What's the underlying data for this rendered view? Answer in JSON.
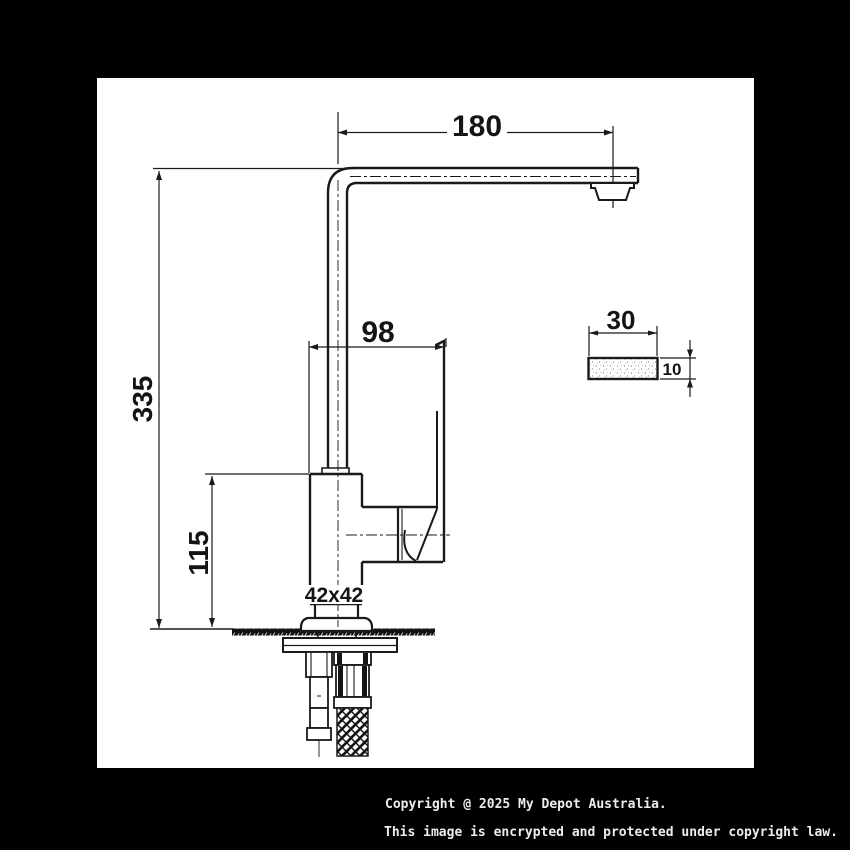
{
  "page": {
    "background": "#000000",
    "paper": "#ffffff",
    "ink": "#1a1a1a"
  },
  "drawing": {
    "title": "kitchen-mixer-tap-technical-drawing",
    "dimensions": {
      "spout_reach": "180",
      "overall_height": "335",
      "body_to_handle_tip": "98",
      "deck_to_spout_height": "115",
      "body_section": "42x42",
      "section_width": "30",
      "section_thickness": "10"
    }
  },
  "footer": {
    "line1": "Copyright @ 2025 My Depot Australia.",
    "line2": "This image is encrypted and protected under copyright law."
  }
}
